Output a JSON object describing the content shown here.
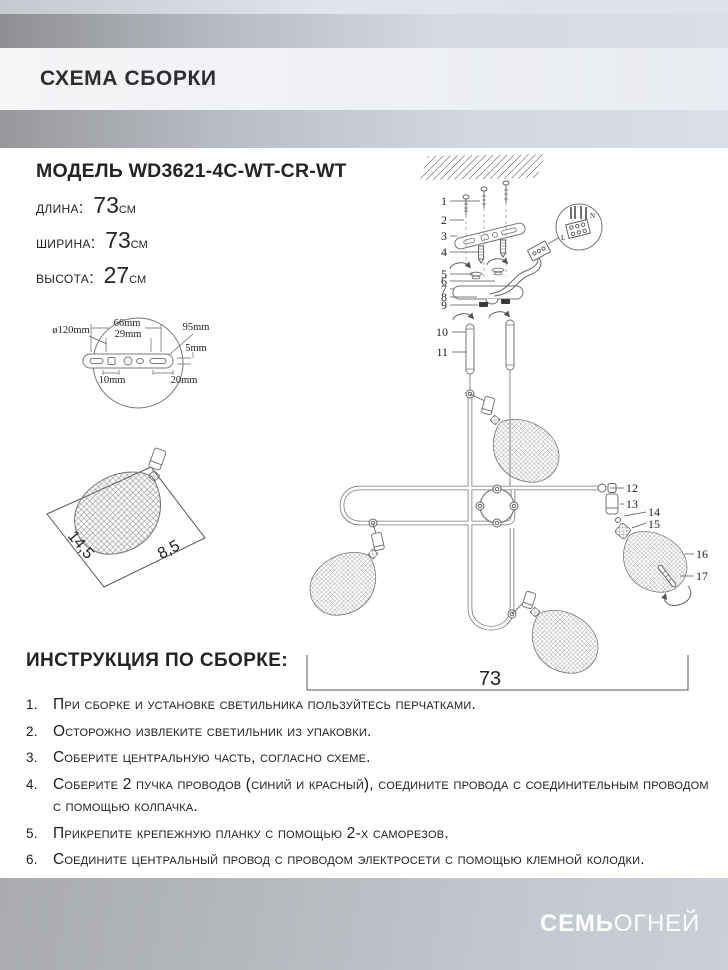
{
  "header": {
    "title": "СХЕМА СБОРКИ"
  },
  "model": {
    "title": "МОДЕЛЬ WD3621-4C-WT-CR-WT",
    "dimensions": [
      {
        "label": "длина:",
        "value": "73",
        "unit": "см"
      },
      {
        "label": "ширина:",
        "value": "73",
        "unit": "см"
      },
      {
        "label": "высота:",
        "value": "27",
        "unit": "см"
      }
    ]
  },
  "plate_diagram": {
    "diameter": "ø120mm",
    "width_top": "66mm",
    "width_inner": "29mm",
    "offset_right": "95mm",
    "thickness": "5mm",
    "hole_left": "10mm",
    "hole_right": "20mm"
  },
  "shade_diagram": {
    "side_long": "14,5",
    "side_short": "8,5"
  },
  "assembly": {
    "part_numbers": [
      "1",
      "2",
      "3",
      "4",
      "5",
      "6",
      "7",
      "8",
      "9",
      "10",
      "11",
      "12",
      "13",
      "14",
      "15",
      "16",
      "17"
    ],
    "wire_labels": {
      "live": "L",
      "neutral": "N"
    },
    "overall_width": "73"
  },
  "instructions": {
    "title": "ИНСТРУКЦИЯ ПО СБОРКЕ:",
    "items": [
      {
        "num": "1.",
        "text": "При сборке и установке светильника пользуйтесь перчатками."
      },
      {
        "num": "2.",
        "text": "Осторожно извлеките светильник из упаковки."
      },
      {
        "num": "3.",
        "text": "Соберите центральную часть, согласно схеме."
      },
      {
        "num": "4.",
        "text": "Соберите 2 пучка проводов (синий и красный), соедините провода с соединительным проводом с помощью колпачка."
      },
      {
        "num": "5.",
        "text": "Прикрепите крепежную планку с помощью 2-х саморезов."
      },
      {
        "num": "6.",
        "text": "Соедините центральный провод с проводом электросети с помощью клемной колодки."
      }
    ]
  },
  "footer": {
    "brand_bold": "СЕМЬ",
    "brand_light": "ОГНЕЙ"
  }
}
